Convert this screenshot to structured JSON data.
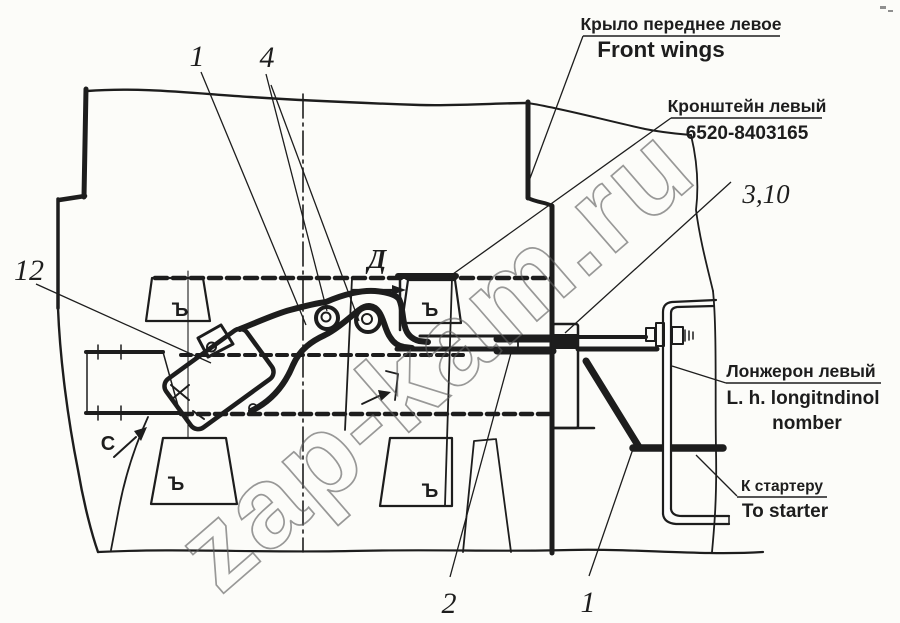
{
  "diagram": {
    "watermark": "zap-kam.ru",
    "labels": {
      "front_wing": {
        "ru": "Крыло переднее левое",
        "en": "Front wings"
      },
      "bracket": {
        "ru": "Кронштейн левый",
        "part_number": "6520-8403165"
      },
      "longeron": {
        "ru": "Лонжерон левый",
        "en_line1": "L. h. longitndinol",
        "en_line2": "nomber"
      },
      "starter": {
        "ru": "К стартеру",
        "en": "To starter"
      }
    },
    "callouts": {
      "lever_12": "12",
      "pedal_1": "1",
      "rollers_4": "4",
      "clamp_3_10": "3,10",
      "rod_2": "2",
      "starter_rod_1": "1"
    },
    "view_arrows": {
      "d": "Д",
      "c": "C"
    },
    "rib_mark": "Ъ",
    "colors": {
      "ink": "#1d1d1d",
      "paper": "#fcfcf9",
      "watermark_outline": "#5a5a5a"
    }
  }
}
